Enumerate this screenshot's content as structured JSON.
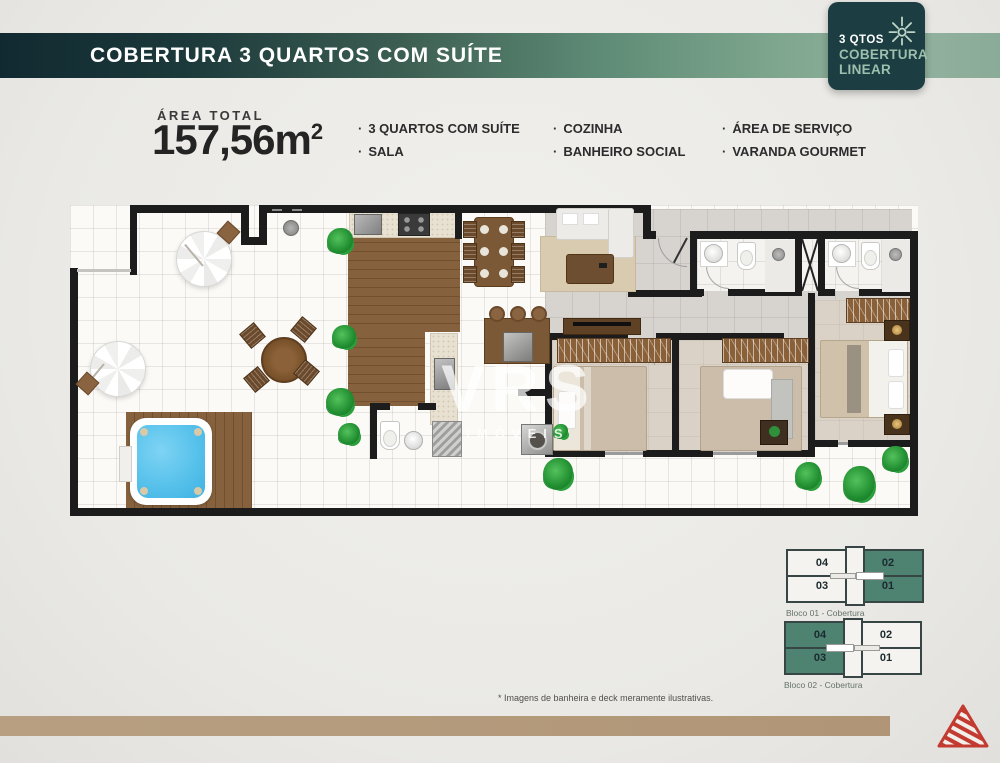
{
  "banner": {
    "title": "COBERTURA 3 QUARTOS COM SUÍTE"
  },
  "badge": {
    "line1": "3 QTOS",
    "line2": "COBERTURA",
    "line3": "LINEAR",
    "icon": "sun-icon"
  },
  "specs": {
    "area_label": "ÁREA TOTAL",
    "area_value": "157,56m",
    "area_sup": "2",
    "features": [
      "3 QUARTOS COM SUÍTE",
      "SALA",
      "COZINHA",
      "BANHEIRO SOCIAL",
      "ÁREA DE SERVIÇO",
      "VARANDA GOURMET"
    ]
  },
  "watermark": {
    "brand": "VRS",
    "sub": "IMÓVEIS"
  },
  "footnote": "* Imagens de banheira e deck meramente ilustrativas.",
  "blocks": [
    {
      "label": "Bloco 01 - Cobertura",
      "units": {
        "top_left": "04",
        "bottom_left": "03",
        "top_right": "02",
        "bottom_right": "01"
      },
      "highlighted_side": "right",
      "highlighted_units": [
        "01",
        "02"
      ]
    },
    {
      "label": "Bloco 02 - Cobertura",
      "units": {
        "top_left": "04",
        "bottom_left": "03",
        "top_right": "02",
        "bottom_right": "01"
      },
      "highlighted_side": "left",
      "highlighted_units": [
        "03",
        "04"
      ]
    }
  ],
  "colors": {
    "teal_dark": "#1c3d41",
    "sage_green": "#4e8372",
    "banner_dark": "#112a31",
    "banner_light": "#93b2a0",
    "bar_tan": "#b49b7e",
    "logo_red": "#c23a30",
    "pool_blue": "#5ac3ec"
  }
}
